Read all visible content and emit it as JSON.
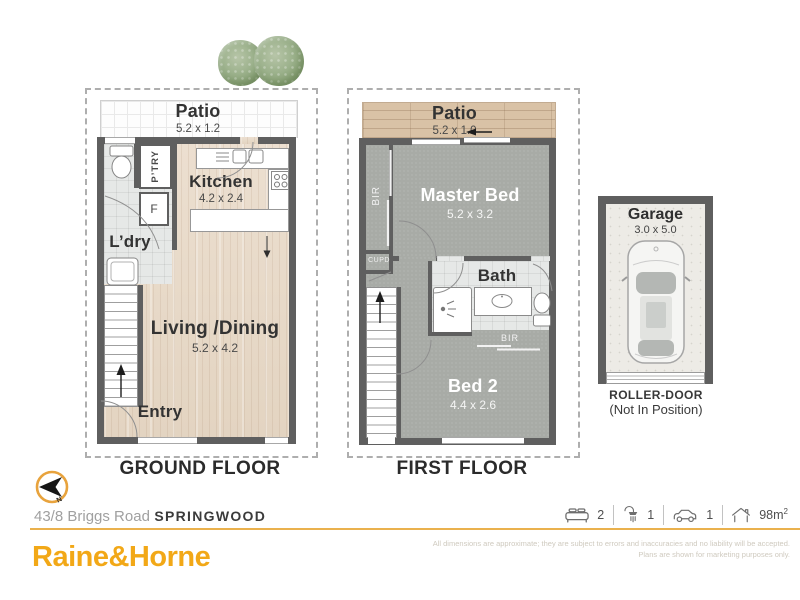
{
  "colors": {
    "brand_gold": "#F2A817",
    "rule_gold": "#EAB14D",
    "wall_gray": "#5F5F5F",
    "carpet_gray": "#A8ABA6",
    "wood_floor": "#E8DBC9",
    "timber_deck": "#D9C2A6"
  },
  "ground_floor": {
    "title": "GROUND FLOOR",
    "patio": {
      "label": "Patio",
      "dims": "5.2 x 1.2"
    },
    "kitchen": {
      "label": "Kitchen",
      "dims": "4.2 x 2.4"
    },
    "pantry": "P’TRY",
    "fridge": "F",
    "laundry": "L’dry",
    "living": {
      "label": "Living /Dining",
      "dims": "5.2 x 4.2"
    },
    "entry": "Entry"
  },
  "first_floor": {
    "title": "FIRST FLOOR",
    "patio": {
      "label": "Patio",
      "dims": "5.2 x 1.0"
    },
    "master": {
      "label": "Master Bed",
      "dims": "5.2 x 3.2"
    },
    "robe_left": "BIR",
    "cupboard": "CUPD",
    "bath": "Bath",
    "robe_bed2": "BIR",
    "bed2": {
      "label": "Bed 2",
      "dims": "4.4 x 2.6"
    }
  },
  "garage": {
    "title": "Garage",
    "dims": "3.0 x 5.0",
    "roller_door": "ROLLER-DOOR",
    "roller_note": "(Not In Position)"
  },
  "footer": {
    "compass_n": "N",
    "address_street": "43/8 Briggs Road",
    "address_suburb": "SPRINGWOOD",
    "stats": {
      "beds": "2",
      "baths": "1",
      "cars": "1",
      "area": "98m",
      "area_sup": "2"
    },
    "disclaimer_line1": "All dimensions are approximate; they are subject to errors and inaccuracies and no liability will be accepted.",
    "disclaimer_line2": "Plans are shown for marketing purposes only.",
    "brand": "Raine&Horne"
  }
}
